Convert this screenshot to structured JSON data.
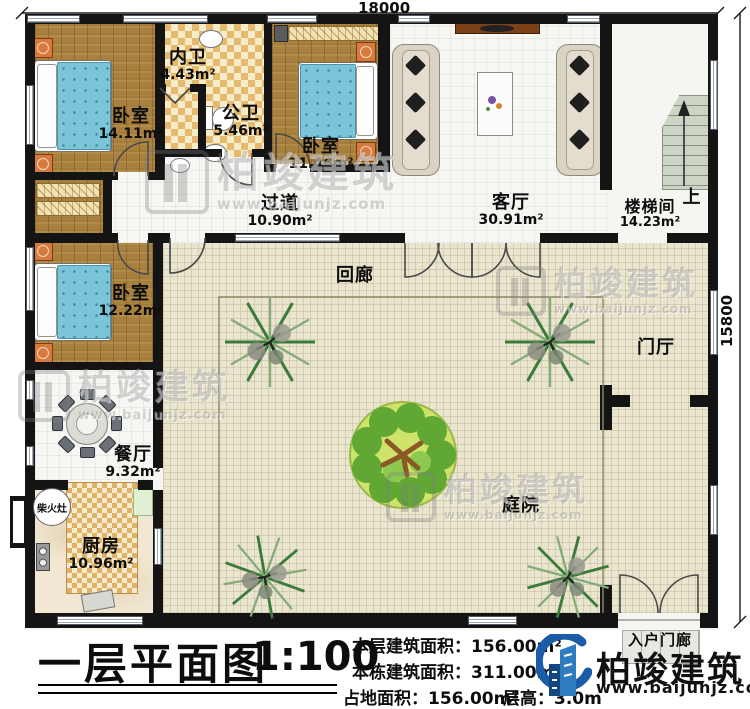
{
  "plan": {
    "dimensions": {
      "top": "18000",
      "right": "15800"
    },
    "rooms": {
      "bedroom_a": {
        "name": "卧室",
        "area": "14.11m²"
      },
      "inner_bath": {
        "name": "内卫",
        "area": "4.43m²"
      },
      "public_bath": {
        "name": "公卫",
        "area": "5.46m²"
      },
      "bedroom_b": {
        "name": "卧室",
        "area": "11.46m²"
      },
      "living_room": {
        "name": "客厅",
        "area": "30.91m²"
      },
      "stair_hall": {
        "name": "楼梯间",
        "area": "14.23m²"
      },
      "corridor": {
        "name": "过道",
        "area": "10.90m²"
      },
      "cloister": {
        "name": "回廊"
      },
      "foyer": {
        "name": "门厅"
      },
      "bedroom_c": {
        "name": "卧室",
        "area": "12.22m²"
      },
      "dining_room": {
        "name": "餐厅",
        "area": "9.32m²"
      },
      "wood_stove": {
        "name": "柴火灶"
      },
      "kitchen": {
        "name": "厨房",
        "area": "10.96m²"
      },
      "courtyard": {
        "name": "庭院"
      },
      "entry_porch": {
        "name": "入户门廊"
      },
      "stairs_up": "上"
    }
  },
  "titleblock": {
    "title": "一层平面图",
    "scale": "1:100",
    "stats": [
      "本层建筑面积：156.00m²",
      "本栋建筑面积：311.00m²",
      "占地面积：156.00m²",
      "层高：3.0m"
    ]
  },
  "brand": {
    "name": "柏竣建筑",
    "url": "www.baijunjz.com"
  },
  "watermark": {
    "name": "柏竣建筑",
    "url": "www.baijunjz.com"
  },
  "colors": {
    "wall": "#141414",
    "wood_floor": "#a8813f",
    "checker_tile": "#e6ba6e",
    "courtyard": "#eae5cf",
    "bed": "#7cc5d8",
    "brand_blue": "#1a5caa"
  }
}
